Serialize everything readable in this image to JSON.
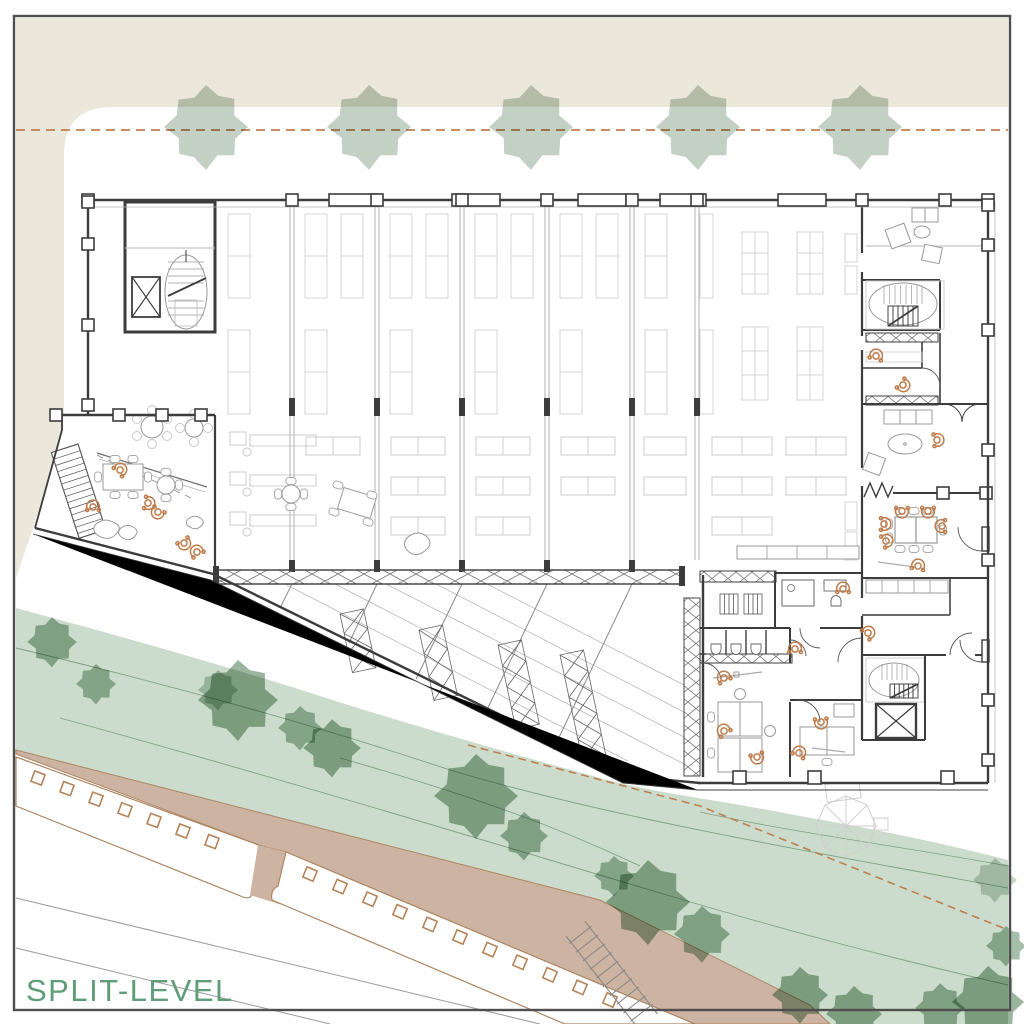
{
  "page": {
    "width": 1024,
    "height": 1024,
    "background": "#ffffff",
    "frame_color": "#4f4f4f"
  },
  "title": {
    "label": "SPLIT-LEVEL",
    "color": "#5f9d78"
  },
  "palette": {
    "site_ground": "#ebe7db",
    "street_tree": "#b9c8ba",
    "greenway_fill": "#ccdccc",
    "greenway_tree": "#8fae94",
    "contour_line": "#7fa182",
    "road_fill": "#cdb3a1",
    "road_edge": "#ad8661",
    "paver_marker": "#b5835a",
    "setback_dash": "#bf8050",
    "wall": "#3c3c3c",
    "partition": "#a8a8a8",
    "furniture": "#9a9a9a",
    "shelving": "#d6d6d6",
    "truss": "#6f6f6f",
    "people": "#bf7c4b",
    "pavilion": "#cfcfcf",
    "label_green": "#5f9d78"
  },
  "street_trees": {
    "count": 5,
    "y": 127,
    "scale": 1.05,
    "x_positions": [
      206,
      369,
      531,
      698,
      860
    ]
  },
  "greenway_trees": [
    [
      52,
      642,
      0.62,
      0.85
    ],
    [
      96,
      684,
      0.5,
      0.8
    ],
    [
      218,
      690,
      0.5,
      0.6
    ],
    [
      238,
      700,
      1.0,
      0.9
    ],
    [
      300,
      728,
      0.55,
      0.8
    ],
    [
      332,
      748,
      0.72,
      0.9
    ],
    [
      476,
      796,
      1.05,
      0.9
    ],
    [
      524,
      836,
      0.6,
      0.85
    ],
    [
      614,
      876,
      0.5,
      0.8
    ],
    [
      648,
      902,
      1.05,
      0.9
    ],
    [
      702,
      934,
      0.7,
      0.85
    ],
    [
      800,
      995,
      0.7,
      0.9
    ],
    [
      854,
      1014,
      0.7,
      0.9
    ],
    [
      940,
      1008,
      0.62,
      0.85
    ],
    [
      988,
      1002,
      0.9,
      0.9
    ],
    [
      1006,
      946,
      0.5,
      0.8
    ],
    [
      995,
      880,
      0.55,
      0.5
    ]
  ],
  "sidewalk_markers": {
    "segments": [
      {
        "start": [
          38,
          778
        ],
        "step": [
          29,
          10.6
        ],
        "count": 7,
        "angle": 20
      },
      {
        "start": [
          310,
          874
        ],
        "step": [
          30,
          12.6
        ],
        "count": 11,
        "angle": 23
      }
    ]
  },
  "people": [
    [
      93,
      507,
      0
    ],
    [
      120,
      470,
      45
    ],
    [
      148,
      503,
      100
    ],
    [
      158,
      512,
      210
    ],
    [
      184,
      543,
      150
    ],
    [
      197,
      552,
      -30
    ],
    [
      876,
      356,
      15
    ],
    [
      903,
      385,
      130
    ],
    [
      937,
      440,
      85
    ],
    [
      884,
      524,
      90
    ],
    [
      902,
      511,
      180
    ],
    [
      928,
      511,
      180
    ],
    [
      942,
      526,
      -90
    ],
    [
      886,
      541,
      70
    ],
    [
      918,
      566,
      10
    ],
    [
      868,
      633,
      50
    ],
    [
      795,
      649,
      0
    ],
    [
      724,
      678,
      -25
    ],
    [
      843,
      589,
      0
    ],
    [
      724,
      731,
      -35
    ],
    [
      757,
      757,
      165
    ],
    [
      821,
      722,
      175
    ],
    [
      799,
      753,
      25
    ]
  ]
}
